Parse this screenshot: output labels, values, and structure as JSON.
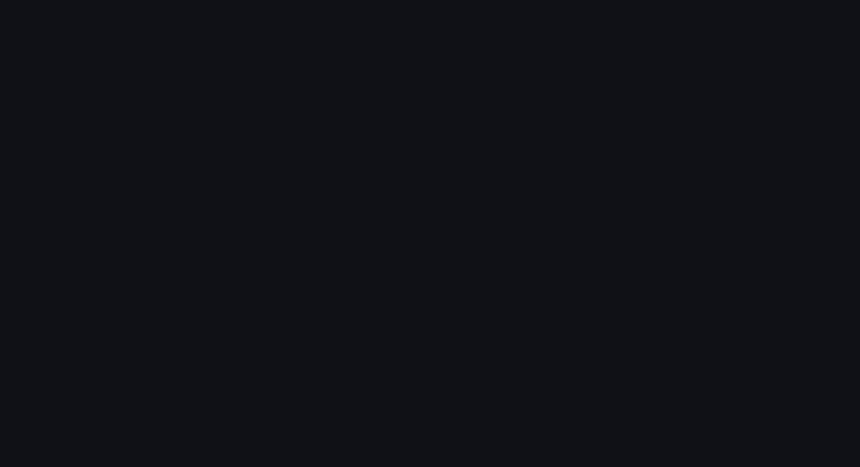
{
  "scene": {
    "type": "architectural-aerial-night-rendering",
    "subject": "lakeside exhibition and convention center complex at dusk",
    "landmarks": [
      "lake",
      "waterfront-park",
      "fan-shaped-exhibition-hall",
      "rainbow-canopy-ribbon",
      "circular-dome-theater",
      "exhibition-hall-rows",
      "highway-with-traffic",
      "city-blocks",
      "canal",
      "teardrop-glass-pavilion",
      "plaza"
    ],
    "facade_sign": {
      "text_legible": false,
      "color": "#3ed2cc"
    },
    "palette": {
      "background": "#15161b",
      "water_top": "#4b525b",
      "water_bottom": "#2a2f37",
      "roof_light": "#cdd2d8",
      "roof_mid": "#9aa3ac",
      "ribbon_left": [
        "#f3ecdc",
        "#f2a6d8",
        "#d6459f",
        "#ef91cc",
        "#f6f0e4",
        "#ecc8e0"
      ],
      "ribbon_right": [
        "#5c6068",
        "#de8140",
        "#f2e0b4",
        "#64686f",
        "#e9974f",
        "#f0d79c"
      ],
      "dome_top": "#c2cfd8",
      "dome_glow": "#ecd2a4",
      "plaza_tan": "#c9a66f",
      "road_glow": "#8a5a2e",
      "street_light": "#ffd9a2",
      "red_trail": "#d24034",
      "white_trail": "#ece9e2",
      "tree_dark": "#1c2416",
      "canal": "#24383c",
      "glass_teal": "#35605a"
    }
  }
}
